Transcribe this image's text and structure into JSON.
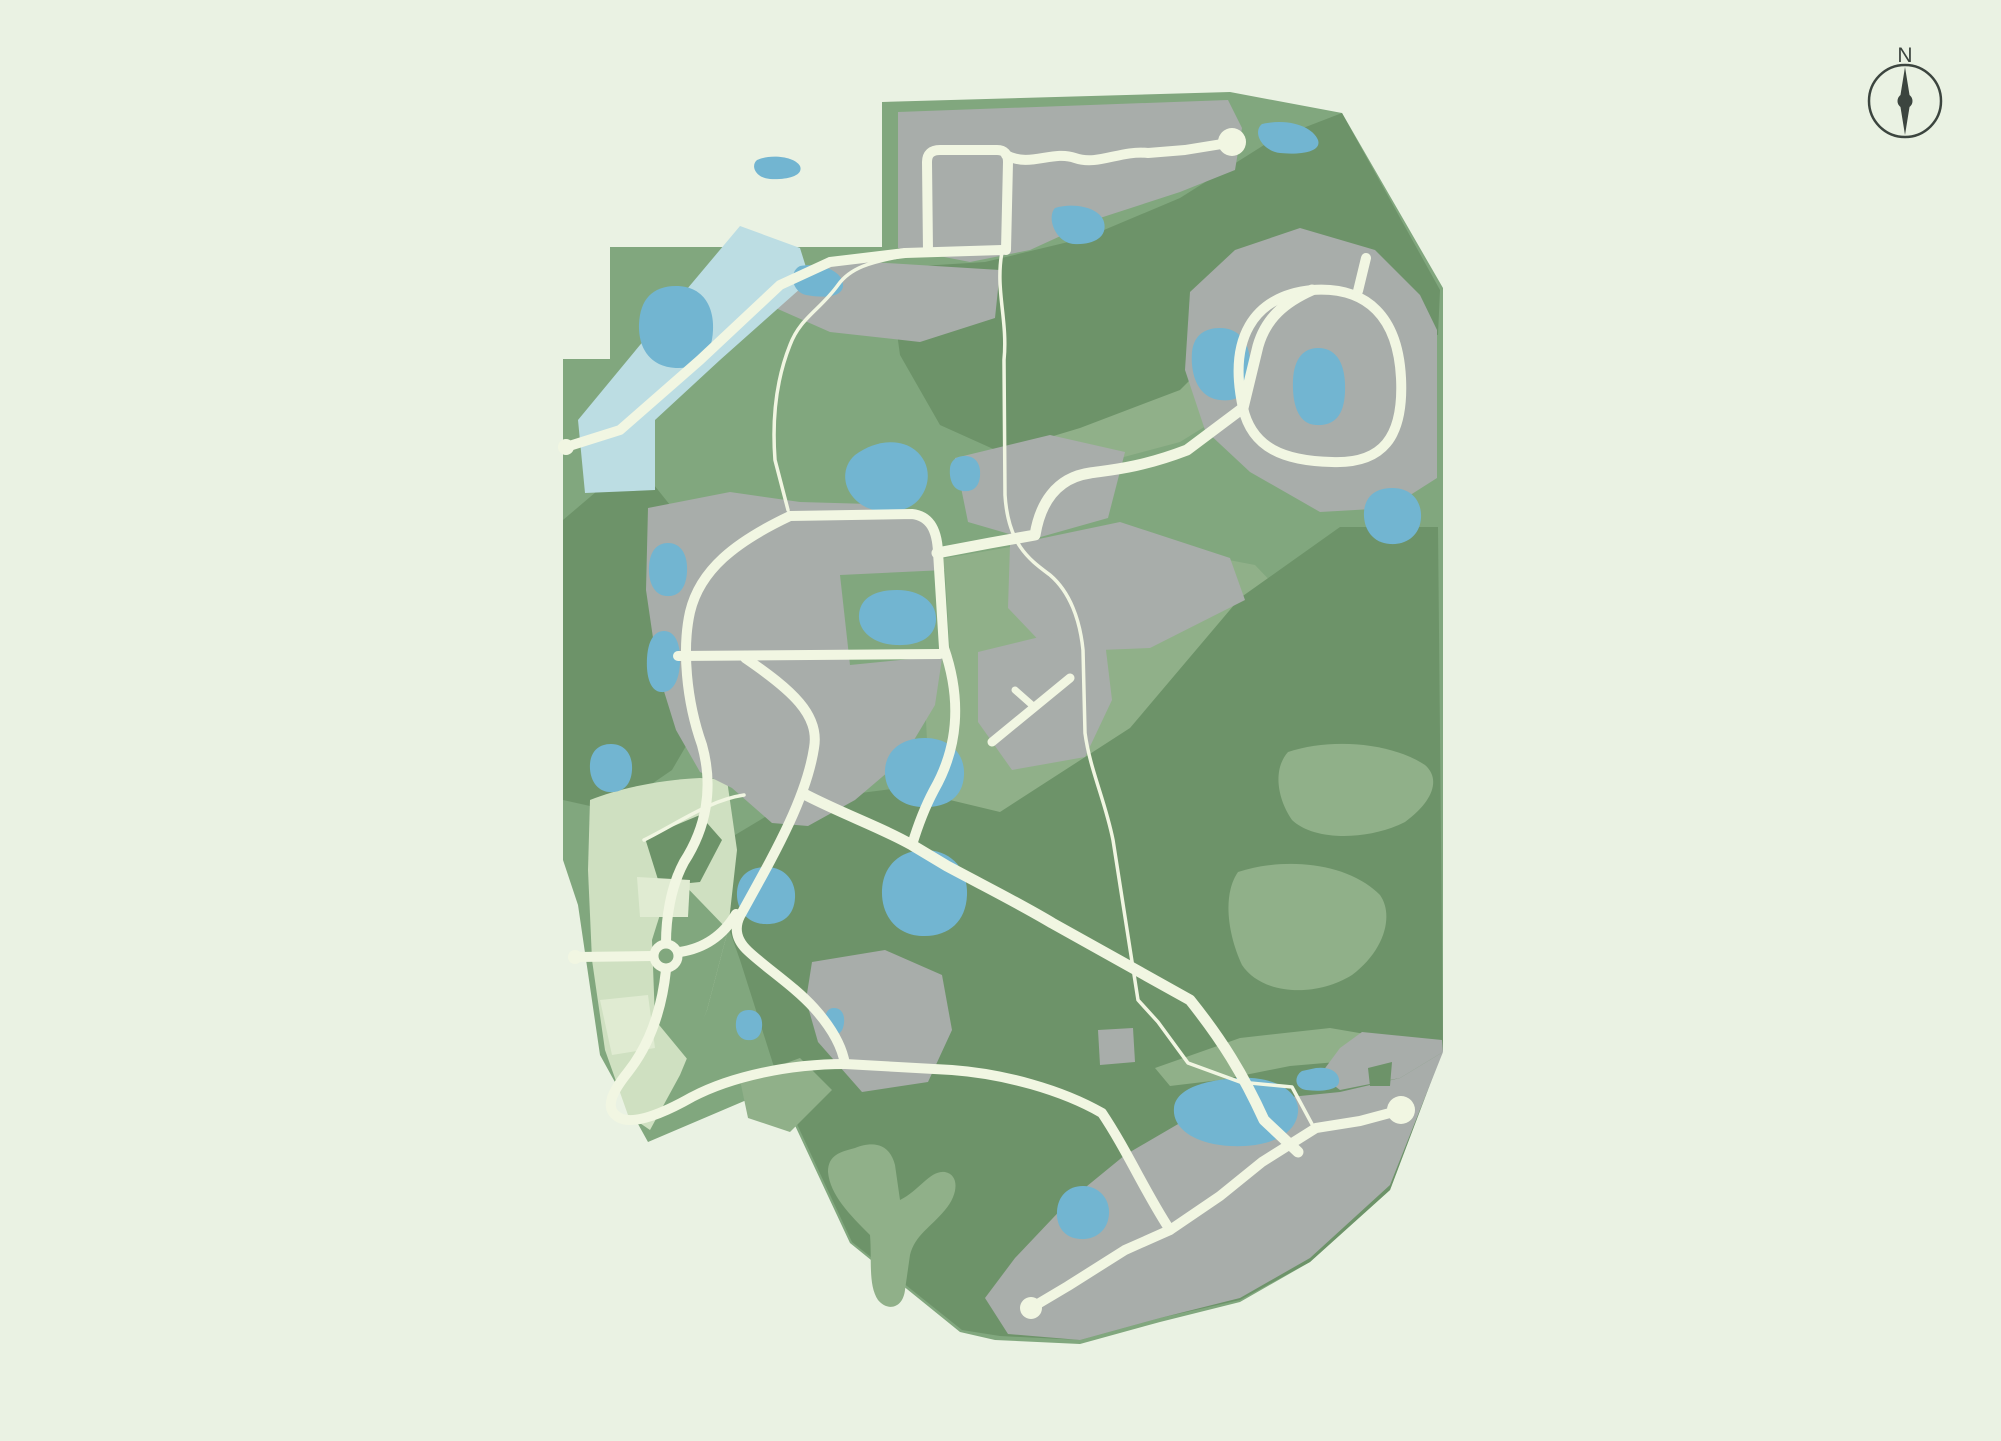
{
  "palette": {
    "background": "#eaf2e3",
    "base_green": "#81a77e",
    "dark_green": "#6d9369",
    "sage_green": "#90b089",
    "pale_zone": "#cfe0c1",
    "pale_light": "#e0ebd2",
    "developed_gray": "#a8adaa",
    "pond_blue": "#72b5d1",
    "river_blue": "#bcdde3",
    "road_cream": "#f1f6e2",
    "ink": "#3c453f"
  },
  "compass": {
    "label": "N"
  },
  "map": {
    "outline": {
      "name": "community-boundary",
      "fill": "base_green",
      "d": "M 882,102 L 1230,92 L 1342,113 L 1443,288 L 1443,1050 L 1390,1190 L 1310,1262 L 1240,1302 L 1160,1322 L 1080,1344 L 995,1340 L 960,1332 L 850,1243 L 777,1087 L 648,1142 L 600,1055 L 578,905 L 563,860 L 563,359 L 610,359 L 610,247 L 882,247 Z"
    },
    "regions": [
      {
        "name": "meadow-north-band",
        "fill": "sage_green",
        "d": "M 890,300 L 1000,265 L 1100,243 L 1190,205 L 1255,160 L 1266,190 L 1180,245 L 1080,285 L 980,325 L 905,348 Z"
      },
      {
        "name": "meadow-mid-band",
        "fill": "sage_green",
        "d": "M 980,335 L 1060,330 L 1140,350 L 1198,366 L 1238,406 L 1180,442 L 1090,466 L 1018,470 L 983,420 Z"
      },
      {
        "name": "meadow-east-of-village",
        "fill": "sage_green",
        "d": "M 935,560 L 1050,540 L 1150,545 L 1255,565 L 1300,612 L 1280,700 L 1220,790 L 1130,860 L 1040,905 L 958,880 L 930,800 L 925,700 Z"
      },
      {
        "name": "forest-west-band",
        "fill": "dark_green",
        "d": "M 563,520 L 610,480 L 642,470 L 682,520 L 720,560 L 725,650 L 700,722 L 672,770 L 640,792 L 590,806 L 563,800 Z"
      },
      {
        "name": "forest-north-ridge",
        "fill": "dark_green",
        "d": "M 888,268 L 985,262 L 1085,238 L 1180,198 L 1272,140 L 1342,113 L 1440,290 L 1438,335 L 1390,330 L 1300,300 L 1240,330 L 1180,390 L 1080,428 L 1000,452 L 940,425 L 900,355 Z"
      },
      {
        "name": "forest-south-woods",
        "fill": "dark_green",
        "d": "M 690,862 L 790,802 L 900,788 L 1000,812 L 1130,728 L 1240,598 L 1340,527 L 1438,527 L 1443,1050 L 1390,1190 L 1310,1262 L 1240,1300 L 1160,1318 L 1080,1340 L 1000,1336 L 962,1330 L 852,1242 L 782,1092 L 740,960 L 718,898 Z"
      },
      {
        "name": "forest-knoll-northeast",
        "fill": "dark_green",
        "d": "M 1377,292 L 1420,300 L 1415,332 L 1370,324 Z"
      },
      {
        "name": "forest-knoll-central",
        "fill": "dark_green",
        "d": "M 770,700 Q 765,688 778,685 Q 800,682 805,698 Q 808,715 792,722 Q 775,725 770,712 Z"
      },
      {
        "name": "meadow-knoll-east-upper",
        "fill": "sage_green",
        "d": "M 1288,752 C 1330,738 1390,742 1425,765 C 1440,778 1435,800 1405,822 C 1370,840 1315,842 1292,820 C 1278,800 1272,770 1288,752 Z"
      },
      {
        "name": "meadow-knoll-east-lower",
        "fill": "sage_green",
        "d": "M 1238,872 C 1280,858 1345,860 1380,895 C 1394,915 1385,950 1352,975 C 1315,998 1262,995 1242,965 C 1228,935 1222,895 1238,872 Z"
      },
      {
        "name": "meadow-y-clearing",
        "fill": "sage_green",
        "d": "M 855,1148 C 875,1140 890,1145 895,1165 L 900,1200 C 920,1190 930,1170 945,1172 C 960,1175 958,1195 945,1210 C 930,1228 915,1235 910,1255 L 905,1290 C 903,1308 888,1312 878,1300 C 868,1285 872,1260 870,1235 C 850,1215 830,1195 828,1172 C 828,1155 840,1152 855,1148 Z"
      },
      {
        "name": "meadow-southwest-clearing",
        "fill": "sage_green",
        "d": "M 740,1080 L 800,1058 L 832,1090 L 790,1132 L 748,1118 Z"
      },
      {
        "name": "meadow-southeast-band",
        "fill": "sage_green",
        "d": "M 1155,1068 L 1240,1038 L 1330,1028 L 1400,1040 L 1360,1060 L 1290,1066 L 1220,1080 L 1170,1086 Z"
      },
      {
        "name": "future-phase-zone",
        "fill": "pale_zone",
        "d": "M 590,800 C 620,788 660,780 700,778 L 727,780 L 737,850 L 728,930 L 707,1010 L 680,1075 L 650,1130 L 628,1115 L 605,1050 L 592,960 L 588,870 Z"
      },
      {
        "name": "future-phase-woodlot",
        "fill": "dark_green",
        "d": "M 645,838 L 700,815 L 722,840 L 700,882 L 660,886 Z"
      },
      {
        "name": "future-phase-green-wedge",
        "fill": "base_green",
        "d": "M 673,873 L 728,930 L 707,1010 L 688,1060 L 655,1020 L 652,940 Z"
      },
      {
        "name": "future-phase-parcel-light-a",
        "fill": "pale_light",
        "d": "M 637,877 L 690,880 L 688,917 L 640,917 Z"
      },
      {
        "name": "future-phase-parcel-light-b",
        "fill": "pale_light",
        "d": "M 600,1000 L 648,995 L 655,1048 L 612,1055 Z"
      },
      {
        "name": "neighborhood-north-strip",
        "fill": "developed_gray",
        "d": "M 898,112 L 1228,100 L 1242,128 L 1235,170 L 1180,192 L 1100,218 L 1030,250 L 970,262 L 898,248 Z"
      },
      {
        "name": "neighborhood-north-lower",
        "fill": "developed_gray",
        "d": "M 760,270 L 870,262 L 1000,270 L 995,318 L 920,342 L 830,332 L 762,302 Z"
      },
      {
        "name": "neighborhood-northeast-loop",
        "fill": "developed_gray",
        "d": "M 1190,292 L 1235,250 L 1300,228 L 1375,250 L 1420,295 L 1437,330 L 1437,478 L 1390,508 L 1320,512 L 1250,472 L 1205,430 L 1185,370 Z"
      },
      {
        "name": "village-center-west",
        "fill": "developed_gray",
        "d": "M 648,508 L 730,492 L 800,502 L 870,504 L 925,515 L 940,550 L 944,645 L 935,705 L 902,760 L 855,800 L 808,826 L 772,823 L 732,788 L 700,772 L 676,730 L 658,672 L 646,590 Z"
      },
      {
        "name": "village-green-notch",
        "fill": "base_green",
        "d": "M 840,575 L 945,570 L 950,655 L 850,665 Z"
      },
      {
        "name": "village-upper-east",
        "fill": "developed_gray",
        "d": "M 955,458 L 1050,435 L 1125,452 L 1108,518 L 1030,540 L 968,522 Z"
      },
      {
        "name": "village-east-lobe",
        "fill": "developed_gray",
        "d": "M 1010,545 L 1120,522 L 1230,558 L 1245,600 L 1150,648 L 1050,652 L 1008,608 Z"
      },
      {
        "name": "village-southeast-lobe",
        "fill": "developed_gray",
        "d": "M 978,652 L 1060,632 L 1105,642 L 1112,700 L 1085,757 L 1012,770 L 978,722 Z"
      },
      {
        "name": "hamlet-south",
        "fill": "developed_gray",
        "d": "M 812,962 L 885,950 L 942,975 L 952,1030 L 928,1082 L 862,1092 L 818,1042 L 806,1000 Z"
      },
      {
        "name": "neighborhood-southeast-strip",
        "fill": "developed_gray",
        "d": "M 985,1298 L 1015,1258 L 1070,1200 L 1125,1155 L 1185,1120 L 1260,1100 L 1340,1092 L 1400,1078 L 1443,1052 L 1390,1185 L 1310,1258 L 1240,1298 L 1160,1318 L 1080,1340 L 1008,1334 Z"
      },
      {
        "name": "neighborhood-southeast-corner",
        "fill": "developed_gray",
        "d": "M 1362,1032 L 1442,1040 L 1443,1052 L 1400,1078 L 1340,1090 L 1320,1075 L 1340,1048 Z"
      },
      {
        "name": "forest-notch-southeast",
        "fill": "dark_green",
        "d": "M 1368,1068 L 1392,1062 L 1390,1086 L 1370,1086 Z"
      },
      {
        "name": "neighborhood-southeast-block",
        "fill": "developed_gray",
        "d": "M 1098,1030 L 1133,1028 L 1135,1062 L 1100,1065 Z"
      },
      {
        "name": "river-channel",
        "fill": "river_blue",
        "d": "M 740,226 L 800,248 L 810,280 L 720,360 L 655,420 L 655,490 L 585,493 L 578,420 L 640,345 Z"
      },
      {
        "name": "pond-northwest",
        "fill": "pond_blue",
        "d": "M 676,286 C 702,286 714,305 713,330 C 712,355 700,368 678,368 C 652,368 638,350 639,324 C 640,300 652,286 676,286 Z"
      },
      {
        "name": "pond-river-head",
        "fill": "pond_blue",
        "d": "M 800,266 C 822,262 844,272 843,286 C 842,298 822,298 806,295 C 792,292 788,272 800,266 Z"
      },
      {
        "name": "pond-north-small",
        "fill": "pond_blue",
        "d": "M 757,160 C 770,154 794,156 800,166 C 804,176 786,180 770,179 C 756,178 750,166 757,160 Z"
      },
      {
        "name": "pond-ridge",
        "fill": "pond_blue",
        "d": "M 1055,208 C 1075,202 1100,208 1104,222 C 1108,238 1092,245 1074,244 C 1056,243 1046,218 1055,208 Z"
      },
      {
        "name": "pond-northeast-top",
        "fill": "pond_blue",
        "d": "M 1262,124 C 1288,118 1312,126 1318,140 C 1322,152 1300,155 1280,153 C 1262,151 1252,132 1262,124 Z"
      },
      {
        "name": "pond-loop-west",
        "fill": "pond_blue",
        "d": "M 1220,328 C 1240,328 1252,344 1250,370 C 1248,396 1236,402 1220,400 C 1200,398 1190,378 1192,352 C 1194,334 1206,328 1220,328 Z"
      },
      {
        "name": "pond-loop-inner",
        "fill": "pond_blue",
        "d": "M 1318,348 C 1338,348 1346,366 1345,392 C 1344,416 1334,426 1316,425 C 1298,424 1292,404 1293,380 C 1294,358 1304,348 1318,348 Z"
      },
      {
        "name": "pond-loop-south",
        "fill": "pond_blue",
        "d": "M 1392,488 C 1412,488 1422,502 1421,518 C 1420,534 1408,545 1390,544 C 1372,543 1363,528 1364,512 C 1365,496 1376,488 1392,488 Z"
      },
      {
        "name": "pond-artery",
        "fill": "pond_blue",
        "d": "M 965,456 C 977,456 981,466 980,476 C 979,488 972,492 963,491 C 952,490 949,478 950,468 C 951,460 957,456 965,456 Z"
      },
      {
        "name": "pond-cluster-northwest",
        "fill": "pond_blue",
        "d": "M 855,455 C 875,440 900,438 915,450 C 930,462 932,482 920,498 C 908,514 880,516 862,505 C 842,492 840,468 855,455 Z"
      },
      {
        "name": "pond-village-center",
        "fill": "pond_blue",
        "d": "M 897,590 C 920,590 937,602 936,620 C 935,638 918,646 896,645 C 872,644 858,630 859,615 C 860,598 875,590 897,590 Z"
      },
      {
        "name": "pond-west-upper",
        "fill": "pond_blue",
        "d": "M 668,543 C 681,543 688,555 687,572 C 686,589 678,597 666,596 C 654,595 648,582 649,566 C 650,551 657,543 668,543 Z"
      },
      {
        "name": "pond-west-lower",
        "fill": "pond_blue",
        "d": "M 664,631 C 675,631 681,644 680,663 C 679,682 672,693 661,692 C 650,691 646,676 647,658 C 648,641 654,631 664,631 Z"
      },
      {
        "name": "pond-pale-north",
        "fill": "pond_blue",
        "d": "M 611,744 C 625,744 633,755 632,770 C 631,786 622,793 609,792 C 596,791 589,778 590,764 C 591,751 599,744 611,744 Z"
      },
      {
        "name": "pond-south-a",
        "fill": "pond_blue",
        "d": "M 766,867 C 784,867 796,880 795,898 C 794,916 782,925 764,924 C 746,923 736,908 737,892 C 738,876 749,867 766,867 Z"
      },
      {
        "name": "pond-south-b",
        "fill": "pond_blue",
        "d": "M 925,850 C 950,850 968,868 967,895 C 966,922 948,937 922,936 C 896,935 881,915 882,890 C 883,866 900,850 925,850 Z"
      },
      {
        "name": "pond-south-c",
        "fill": "pond_blue",
        "d": "M 925,738 C 948,738 965,752 964,775 C 963,798 946,808 922,807 C 898,806 884,790 885,770 C 886,750 902,738 925,738 Z"
      },
      {
        "name": "pond-hamlet",
        "fill": "pond_blue",
        "d": "M 834,1008 C 841,1008 845,1014 844,1023 C 843,1032 839,1035 833,1034 C 827,1033 824,1026 825,1018 C 826,1011 829,1008 834,1008 Z"
      },
      {
        "name": "pond-pale-zone",
        "fill": "pond_blue",
        "d": "M 749,1010 C 758,1010 763,1017 762,1027 C 761,1037 755,1041 747,1040 C 739,1039 735,1031 736,1022 C 737,1013 742,1010 749,1010 Z"
      },
      {
        "name": "pond-southeast-small",
        "fill": "pond_blue",
        "d": "M 1316,1068 C 1332,1066 1340,1074 1339,1082 C 1338,1090 1322,1092 1306,1090 C 1294,1088 1294,1076 1302,1071 Z"
      },
      {
        "name": "pond-southeast-large",
        "fill": "pond_blue",
        "d": "M 1238,1078 C 1272,1076 1300,1090 1298,1112 C 1296,1136 1266,1148 1230,1146 C 1194,1144 1172,1128 1174,1108 C 1176,1088 1206,1080 1238,1078 Z"
      },
      {
        "name": "pond-southwest-block",
        "fill": "pond_blue",
        "d": "M 1083,1186 C 1098,1186 1110,1198 1109,1214 C 1108,1230 1096,1240 1080,1239 C 1064,1238 1056,1226 1057,1211 C 1058,1196 1068,1186 1083,1186 Z"
      }
    ],
    "roads": [
      {
        "name": "river-road",
        "w": 10,
        "d": "M 566,447 L 620,430 L 700,360 L 780,285 L 830,262 L 905,253"
      },
      {
        "name": "north-road",
        "w": 10,
        "d": "M 905,253 L 1002,250"
      },
      {
        "name": "north-loop-road",
        "w": 10,
        "d": "M 928,252 L 927,162 Q 927,150 940,150 L 997,150 Q 1008,150 1008,162 L 1006,250"
      },
      {
        "name": "north-ridge-road",
        "w": 10,
        "d": "M 1006,155 C 1030,168 1052,150 1075,158 C 1098,166 1120,150 1148,153 L 1185,150 L 1222,144"
      },
      {
        "name": "northeast-loop-road",
        "w": 10,
        "d": "M 1243,408 C 1228,340 1252,296 1312,290 C 1368,286 1398,318 1401,378 C 1404,438 1382,464 1332,462 C 1284,461 1252,448 1243,408 Z"
      },
      {
        "name": "northeast-loop-stub",
        "w": 10,
        "d": "M 1358,291 L 1366,258"
      },
      {
        "name": "main-artery",
        "w": 11,
        "d": "M 1312,290 C 1285,302 1266,318 1258,346 L 1243,408 L 1187,450 C 1140,468 1110,470 1090,473 C 1055,478 1040,505 1035,535 L 990,543 L 937,553"
      },
      {
        "name": "village-north-road",
        "w": 10,
        "d": "M 790,516 L 912,514 C 930,516 937,530 938,552 L 944,648"
      },
      {
        "name": "village-cross-road",
        "w": 10,
        "d": "M 678,656 L 940,654"
      },
      {
        "name": "village-west-curve",
        "w": 10,
        "d": "M 790,516 C 735,542 700,570 690,612 C 682,648 686,700 702,745 C 714,788 706,828 684,862 C 670,888 666,920 666,943"
      },
      {
        "name": "village-south-curve",
        "w": 10,
        "d": "M 745,658 C 792,690 820,715 814,748 C 806,800 772,858 740,916 C 734,928 736,940 748,951 C 766,968 794,986 814,1008 C 832,1028 842,1046 845,1064"
      },
      {
        "name": "village-east-down-road",
        "w": 10,
        "d": "M 944,648 C 962,700 958,748 934,790 C 926,805 918,825 912,845"
      },
      {
        "name": "southeast-parkway",
        "w": 11,
        "d": "M 806,795 C 845,815 880,827 912,845 L 947,866 C 992,890 1022,905 1052,923 L 1190,1000 C 1222,1040 1243,1074 1264,1120 L 1298,1152"
      },
      {
        "name": "roundabout-west-spoke",
        "w": 10,
        "d": "M 652,956 L 578,957"
      },
      {
        "name": "roundabout-east-spoke",
        "w": 10,
        "d": "M 680,952 C 706,948 724,934 736,914"
      },
      {
        "name": "pale-zone-loop",
        "w": 10,
        "d": "M 666,970 C 662,1008 650,1044 628,1072 C 612,1092 604,1108 618,1117 C 632,1126 662,1114 692,1097 C 732,1076 790,1064 845,1064"
      },
      {
        "name": "southwest-connector",
        "w": 10,
        "d": "M 845,1064 L 952,1070 C 1005,1074 1062,1090 1102,1113 C 1128,1152 1145,1192 1170,1230"
      },
      {
        "name": "south-shore-road",
        "w": 10,
        "d": "M 1031,1308 L 1068,1286 L 1125,1250 L 1170,1230 L 1220,1196 L 1262,1162 L 1316,1128 L 1360,1121 L 1401,1110"
      },
      {
        "name": "airstrip-lane",
        "w": 9,
        "d": "M 992,742 L 1070,678"
      },
      {
        "name": "airstrip-spur",
        "w": 7,
        "d": "M 1032,705 L 1015,690"
      },
      {
        "name": "trail-west",
        "w": 3.5,
        "d": "M 903,256 C 870,262 850,268 838,285 C 820,310 800,318 790,345 C 776,380 772,420 775,460 L 788,510"
      },
      {
        "name": "trail-long-southeast",
        "w": 3.5,
        "d": "M 1002,252 C 995,290 1008,320 1004,360 L 1005,495 C 1008,545 1030,560 1050,575 C 1070,592 1080,620 1083,650 L 1085,733 C 1090,770 1105,800 1113,840 L 1138,1000 L 1158,1022 L 1188,1063 L 1240,1082 L 1292,1087 L 1313,1126"
      },
      {
        "name": "trail-pale-link",
        "w": 3.5,
        "d": "M 644,840 C 680,822 710,800 744,795"
      }
    ],
    "circles": [
      {
        "name": "cul-de-sac-north",
        "type": "fill",
        "cx": 1232,
        "cy": 142,
        "r": 14
      },
      {
        "name": "cul-de-sac-southeast",
        "type": "fill",
        "cx": 1401,
        "cy": 1110,
        "r": 14
      },
      {
        "name": "cul-de-sac-south",
        "type": "fill",
        "cx": 1031,
        "cy": 1308,
        "r": 11
      },
      {
        "name": "roundabout",
        "type": "ring",
        "cx": 666,
        "cy": 956,
        "r": 12,
        "w": 9
      },
      {
        "name": "road-stub-west",
        "type": "fill",
        "cx": 566,
        "cy": 447,
        "r": 8
      },
      {
        "name": "road-stub-pale-west",
        "type": "fill",
        "cx": 575,
        "cy": 957,
        "r": 7
      }
    ]
  }
}
